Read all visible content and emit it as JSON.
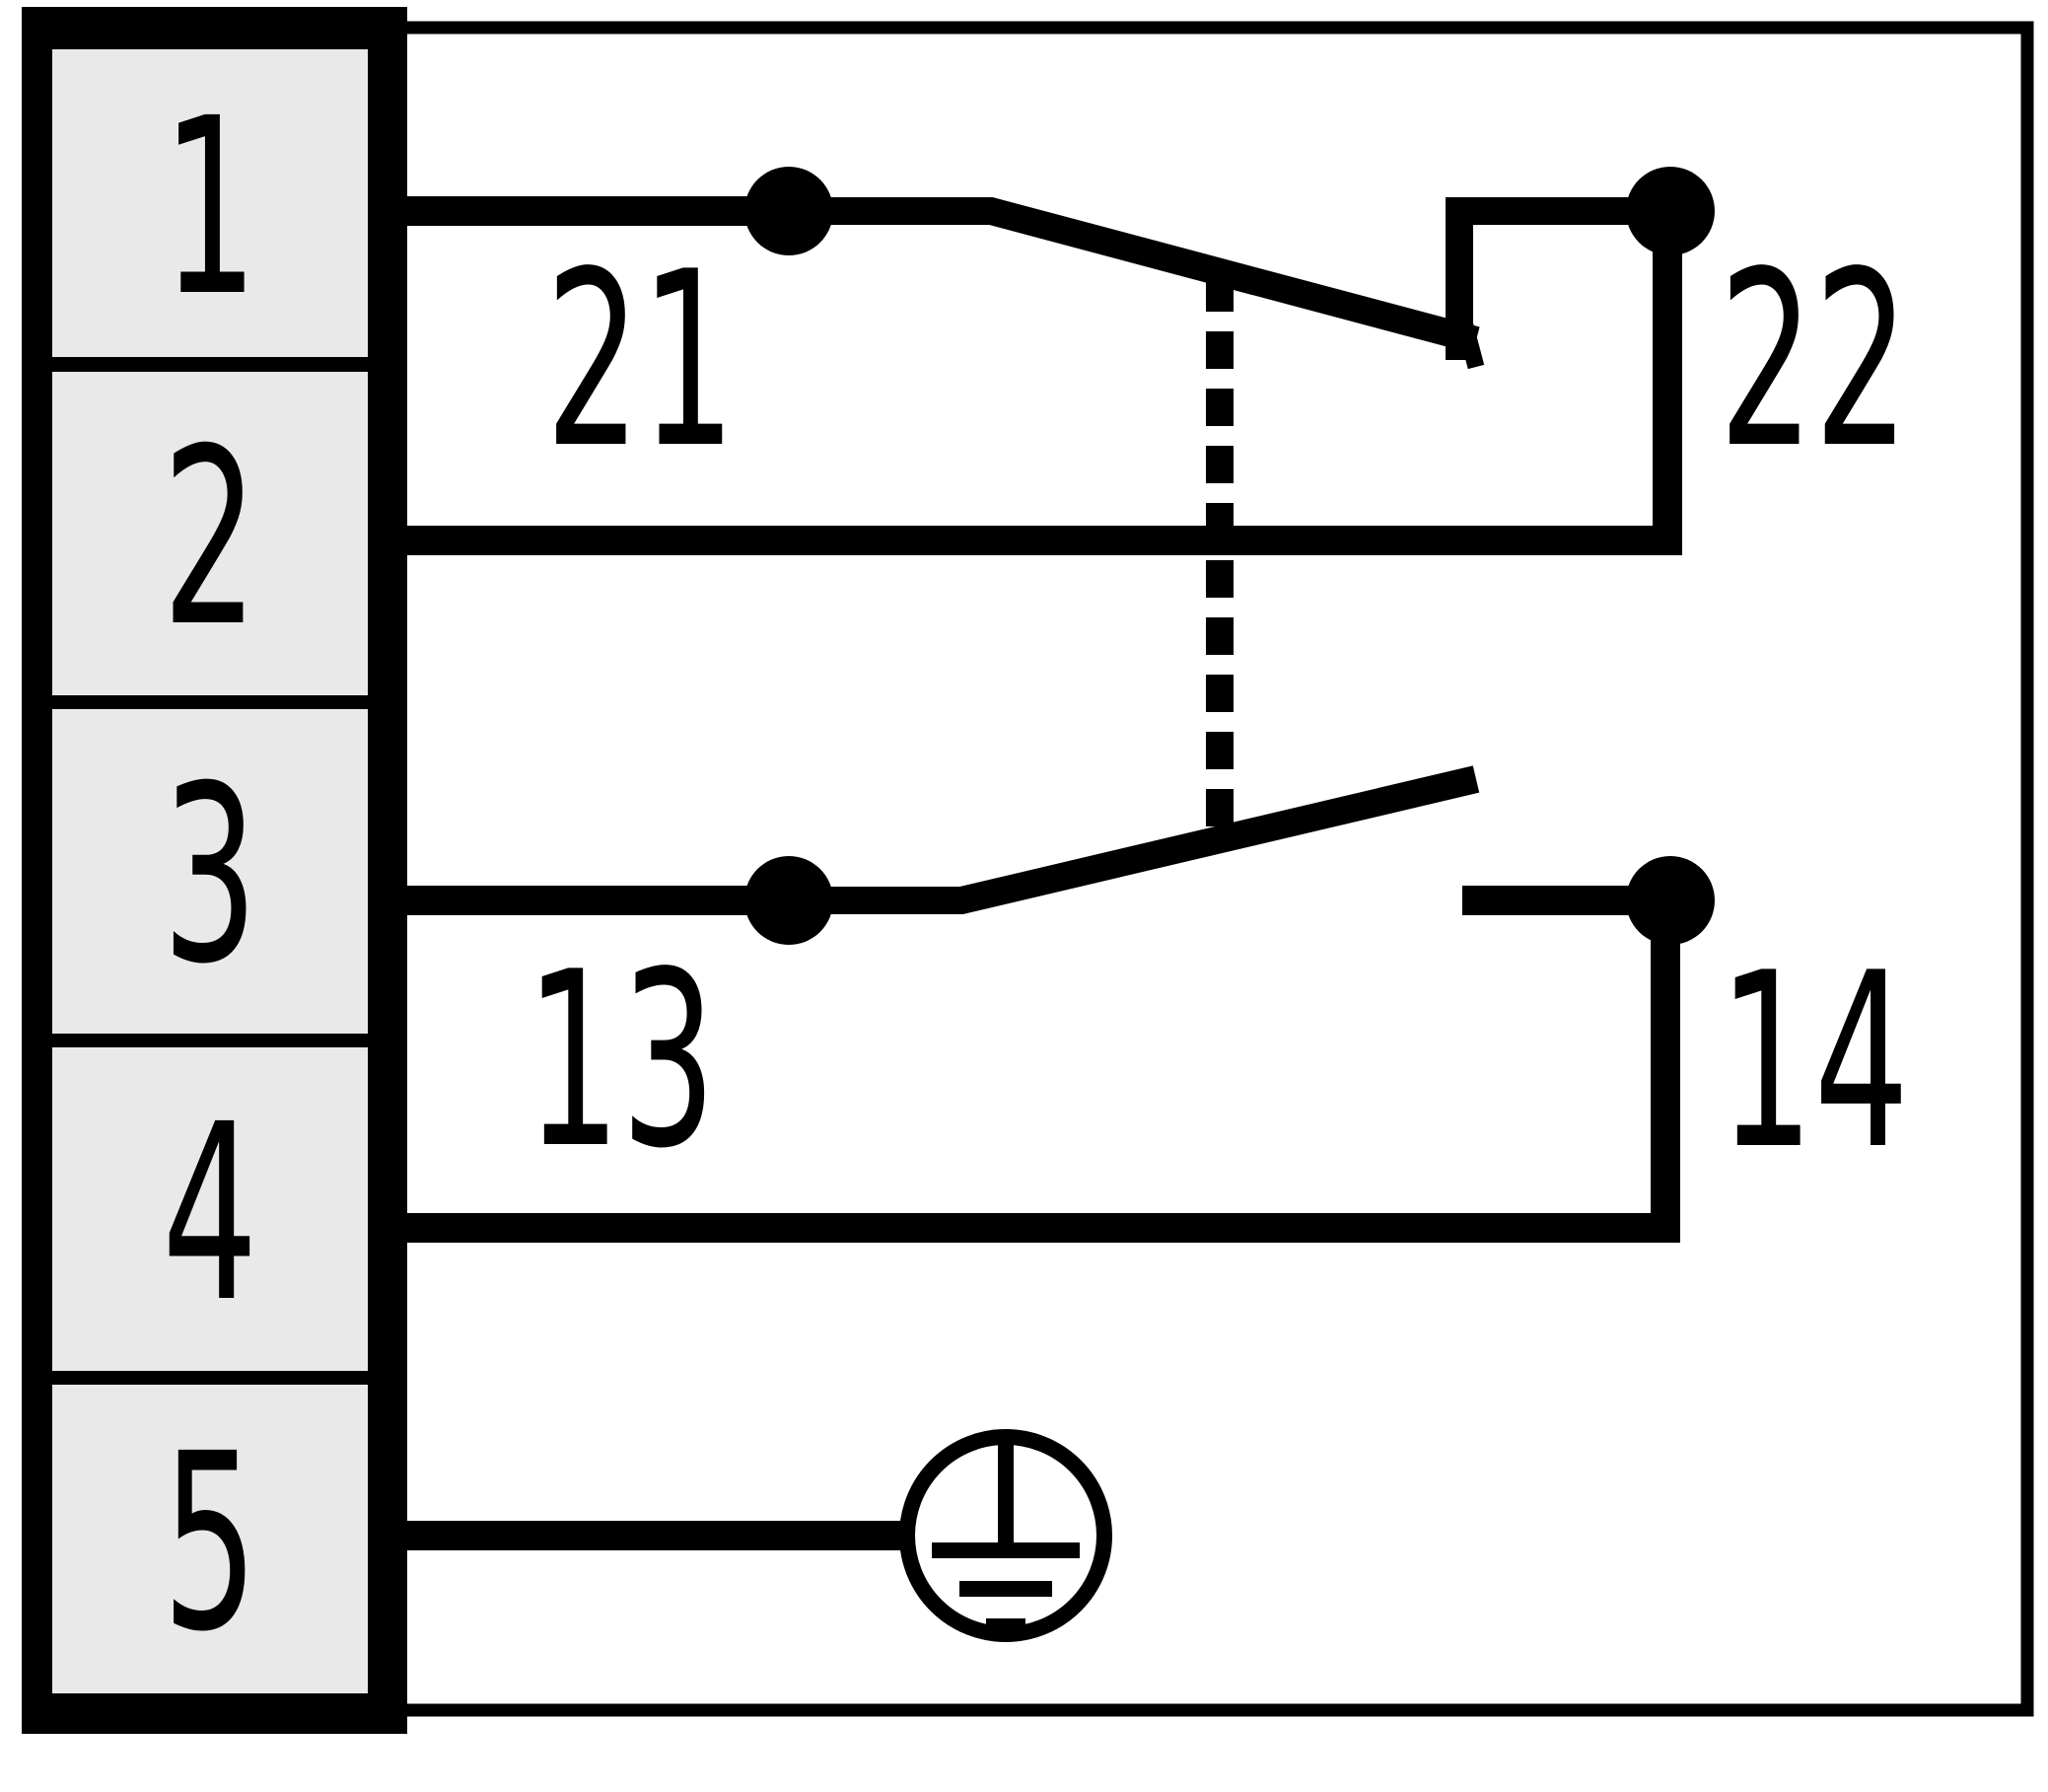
{
  "diagram": {
    "title": "safety-switch-contact-wiring-diagram",
    "terminal_block": {
      "terminals": [
        "1",
        "2",
        "3",
        "4",
        "5"
      ]
    },
    "contacts": {
      "nc_contact": {
        "type": "NC (normally closed, forced opening)",
        "from_label": "21",
        "to_label": "22"
      },
      "no_contact": {
        "type": "NO (normally open)",
        "from_label": "13",
        "to_label": "14"
      },
      "mechanical_link": "dashed-line"
    },
    "labels": {
      "c21": "21",
      "c22": "22",
      "c13": "13",
      "c14": "14"
    },
    "ground": {
      "symbol": "protective-earth-in-circle",
      "connected_terminal": "5"
    },
    "colors": {
      "line": "#000000",
      "terminal_cell_fill": "#e9e9e9",
      "background": "#ffffff"
    }
  }
}
